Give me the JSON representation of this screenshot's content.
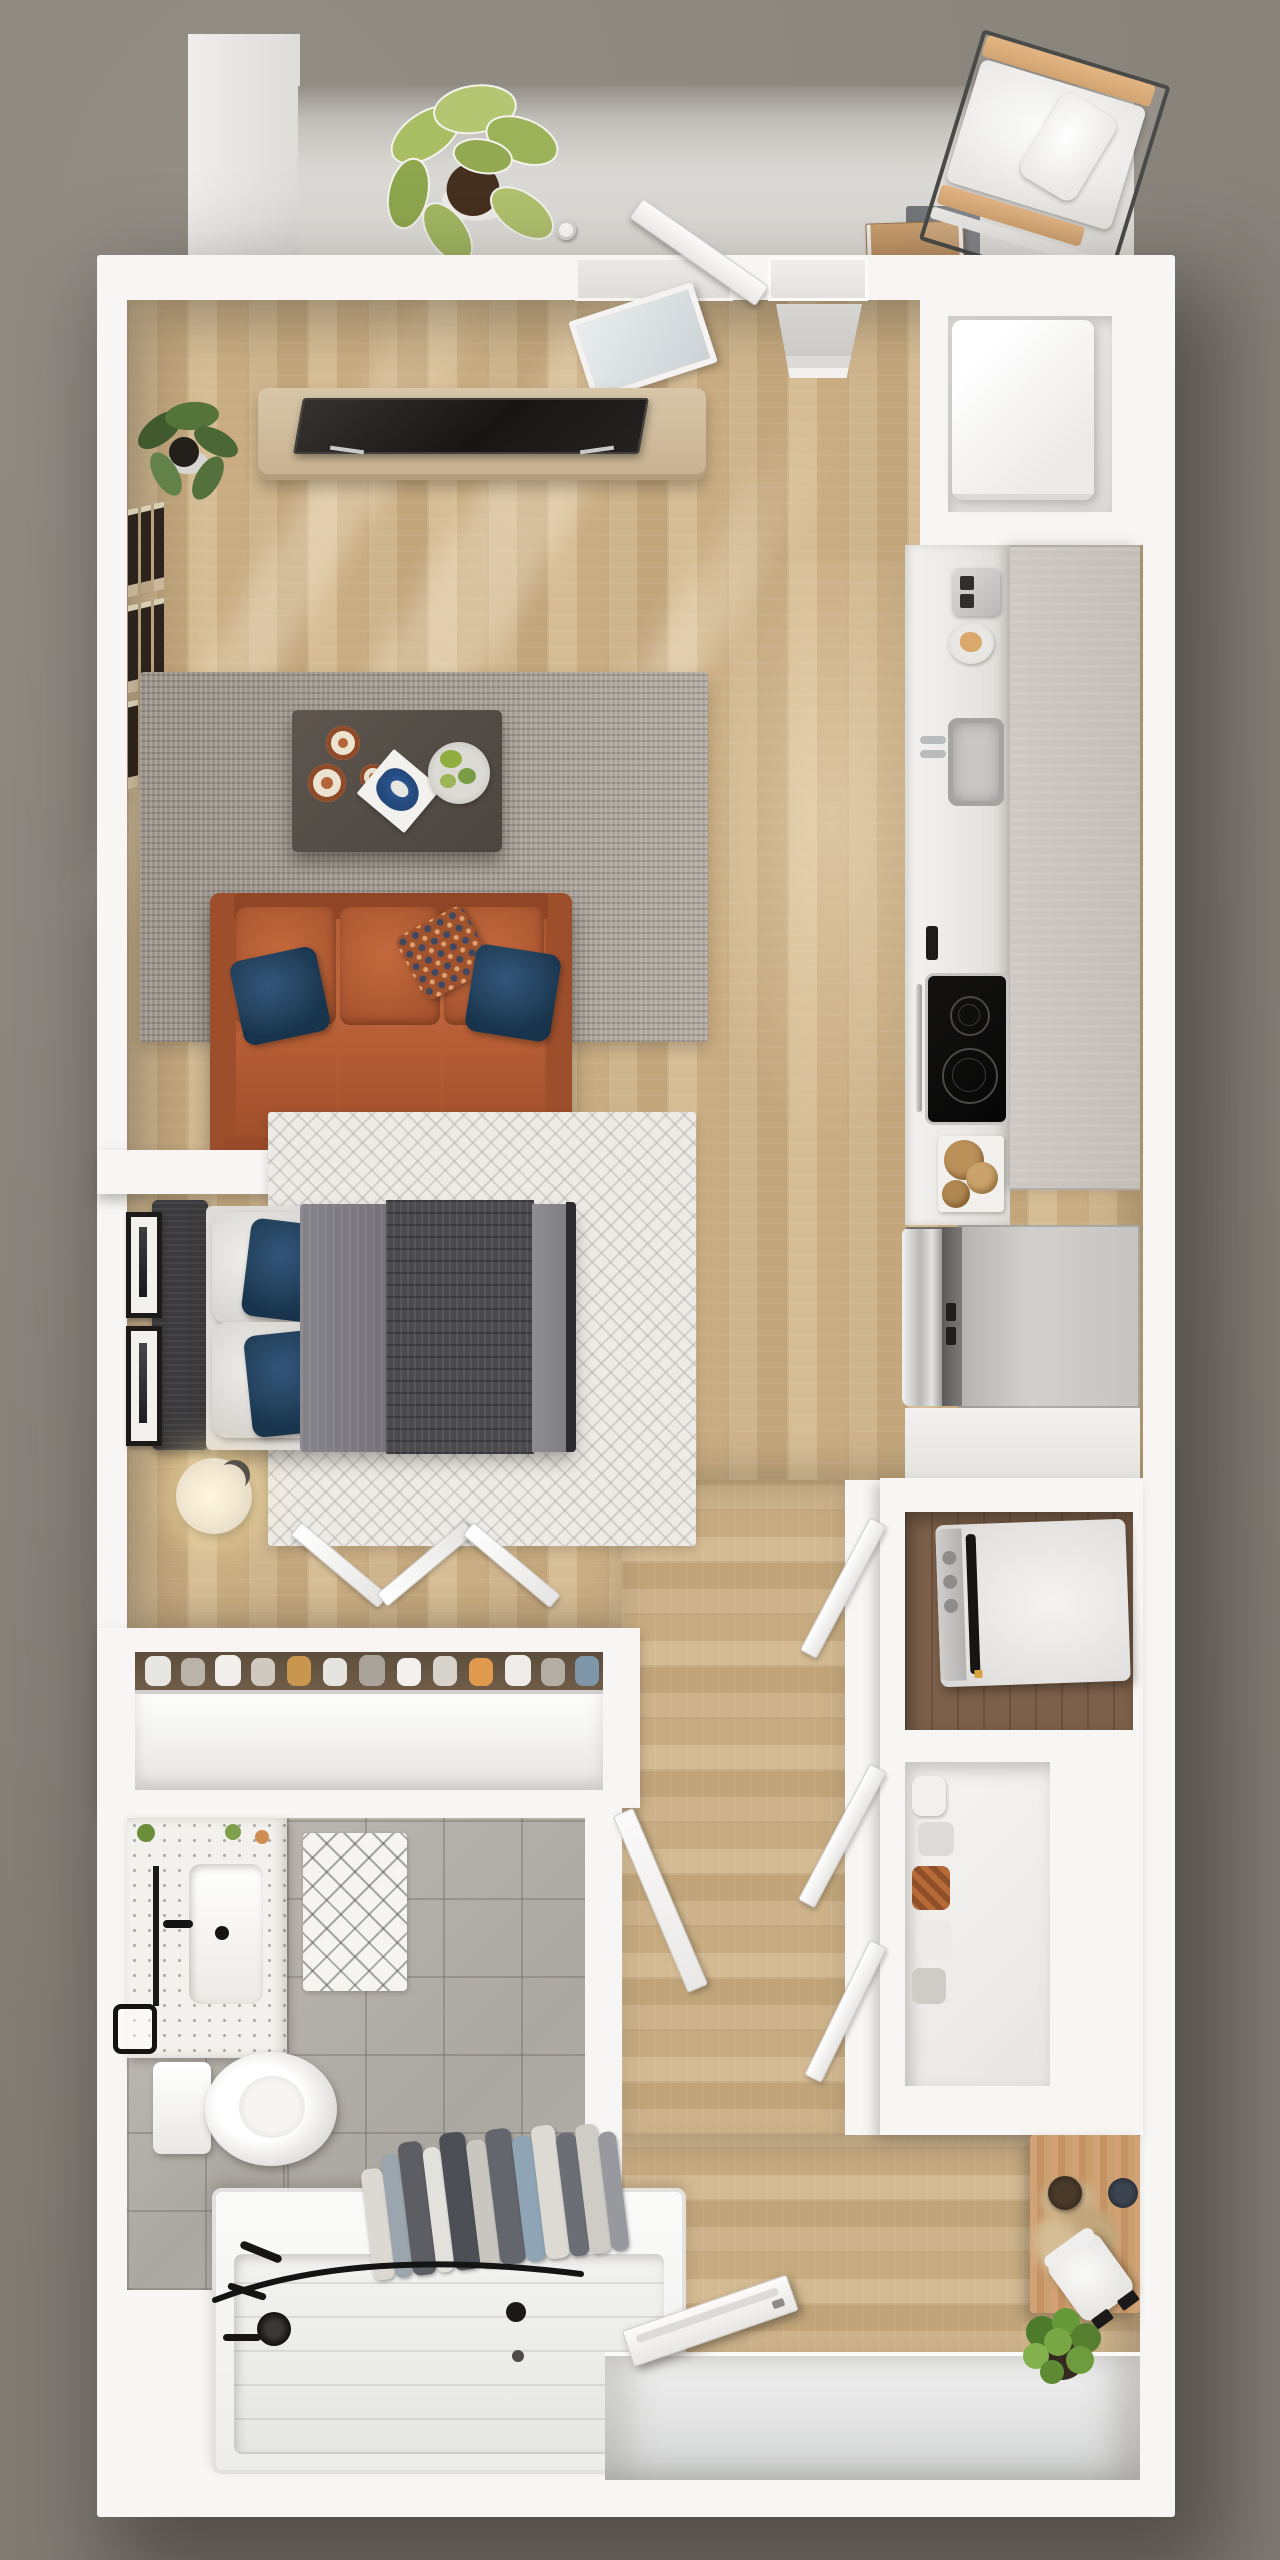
{
  "meta": {
    "scene": "3D top-down rendered floor plan of a one-bedroom apartment with balcony",
    "view": "overhead axonometric",
    "canvas": {
      "width_px": 1280,
      "height_px": 2560
    }
  },
  "palette": {
    "background": "#8B867E",
    "walls": "#F7F6F4",
    "wood_floor": "#CBB087",
    "balcony_concrete": "#DBD9D5",
    "tile_floor": "#AFABA5",
    "living_rug": "#A39C93",
    "bedroom_rug": "#EDEBE7",
    "sofa_leather": "#B05A33",
    "pillow_navy": "#24435F",
    "duvet_gray": "#47474A",
    "counter_marble": "#EDEBE8",
    "cabinet_gray": "#C9C5BE",
    "stainless": "#B9B8B6",
    "desk_wood": "#C9996F",
    "plant_green": "#6F9B3F",
    "fixture_black": "#1C1A18"
  },
  "rooms": {
    "balcony": {
      "label": "Balcony"
    },
    "living_room": {
      "label": "Living room"
    },
    "kitchen": {
      "label": "Kitchen"
    },
    "bedroom": {
      "label": "Bedroom"
    },
    "closet": {
      "label": "Closet"
    },
    "bathroom": {
      "label": "Bathroom"
    },
    "laundry": {
      "label": "Laundry closet"
    },
    "storage": {
      "label": "Storage closet"
    },
    "hallway": {
      "label": "Hallway"
    },
    "entry": {
      "label": "Entry vestibule"
    }
  },
  "furniture": {
    "monstera_plant": {
      "label": "Potted monstera plant"
    },
    "balcony_divider": {
      "label": "White balcony divider wall"
    },
    "outdoor_chair": {
      "label": "Outdoor lounge chair with white cushions"
    },
    "storage_box": {
      "label": "Cardboard storage box"
    },
    "door_mat": {
      "label": "Gray door mat"
    },
    "balcony_door": {
      "label": "Balcony door, ajar"
    },
    "glass_panel": {
      "label": "Leaning glass door panel"
    },
    "balcony_window": {
      "label": "Window opening with sill"
    },
    "media_console": {
      "label": "Wood media console"
    },
    "tv": {
      "label": "Flat-screen TV"
    },
    "corner_plant": {
      "label": "Corner floor plant"
    },
    "gallery_frames": {
      "label": "Gallery wall of narrow picture frames"
    },
    "living_rug": {
      "label": "Gray shag area rug"
    },
    "coffee_table": {
      "label": "Dark wood coffee table"
    },
    "copper_mugs": {
      "label": "Copper mugs"
    },
    "art_book": {
      "label": "Open blue art book"
    },
    "serving_plate": {
      "label": "Plate with greenery"
    },
    "sofa": {
      "label": "Cognac leather three-seat sofa"
    },
    "navy_pillow_left": {
      "label": "Navy throw pillow"
    },
    "navy_pillow_right": {
      "label": "Navy throw pillow"
    },
    "pattern_pillow": {
      "label": "Patterned rust-and-blue throw pillow"
    },
    "water_heater": {
      "label": "Water heater in utility nook"
    },
    "kitchen_counter": {
      "label": "White marble kitchen counter"
    },
    "upper_cabinets": {
      "label": "Gray upper cabinet run"
    },
    "toaster": {
      "label": "Stainless toaster"
    },
    "bread_plate": {
      "label": "Plate with bread"
    },
    "kitchen_sink": {
      "label": "Undermount sink with chrome faucet"
    },
    "cooktop": {
      "label": "Black glass cooktop with two burners"
    },
    "towel_bar": {
      "label": "Chrome towel bar"
    },
    "cutting_boards": {
      "label": "Round wood cutting boards"
    },
    "fridge": {
      "label": "Stainless French-door refrigerator"
    },
    "headboard": {
      "label": "Dark upholstered headboard"
    },
    "bed": {
      "label": "Bed with gray duvet and knit throw"
    },
    "bed_pillows": {
      "label": "White and navy bed pillows"
    },
    "bedroom_rug": {
      "label": "White chevron rug"
    },
    "table_lamp": {
      "label": "Glowing bedside lamp"
    },
    "bedroom_art": {
      "label": "Framed black-and-white wall art"
    },
    "bifold_doors": {
      "label": "Open bifold closet doors"
    },
    "shoe_shelf": {
      "label": "Closet shelf lined with shoes"
    },
    "vanity": {
      "label": "Terrazzo vanity counter with sink"
    },
    "vanity_mirror": {
      "label": "Black-framed mirror"
    },
    "vanity_faucet": {
      "label": "Matte black faucet"
    },
    "bath_mat": {
      "label": "White diamond-pattern bath mat"
    },
    "toilet": {
      "label": "Toilet"
    },
    "towel_ring": {
      "label": "Black towel ring"
    },
    "bathtub": {
      "label": "White alcove bathtub"
    },
    "shower_curtain": {
      "label": "Shower curtain drawn open"
    },
    "curtain_rod": {
      "label": "Curved black shower rod"
    },
    "shower_fixtures": {
      "label": "Matte black shower fixtures"
    },
    "bathroom_door": {
      "label": "Bathroom door, ajar"
    },
    "washer": {
      "label": "Washer-dryer in laundry closet"
    },
    "closet_doors": {
      "label": "Open white closet doors"
    },
    "linen_shelf": {
      "label": "Storage shelves with shoes and baskets"
    },
    "entry_desk": {
      "label": "Wood entry desk"
    },
    "pampas": {
      "label": "Pampas grass arrangement"
    },
    "desk_bowls": {
      "label": "Dark decorative bowls"
    },
    "desk_chair": {
      "label": "White chair with black arms"
    },
    "entry_plant": {
      "label": "Potted green plant"
    },
    "entry_door": {
      "label": "Entry door, ajar"
    },
    "sun_rays": {
      "label": "Sunlight rays across floor"
    }
  }
}
